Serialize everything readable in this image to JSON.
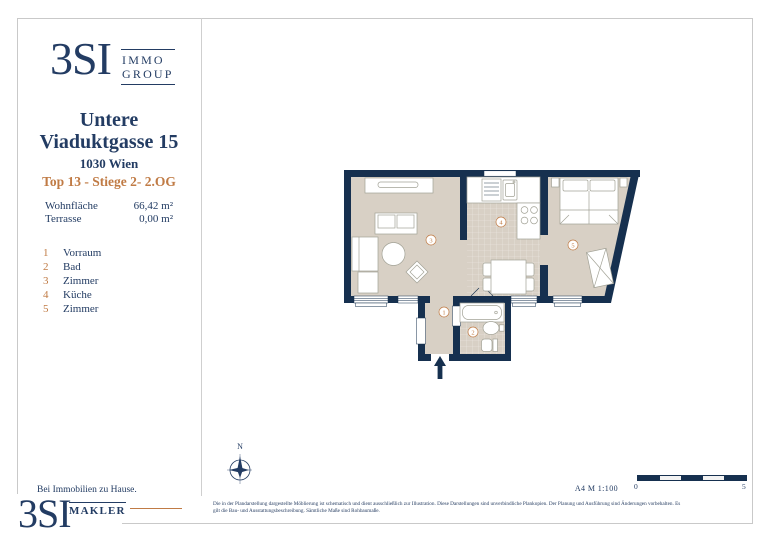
{
  "brand": {
    "name": "3SI",
    "group_line1": "IMMO",
    "group_line2": "GROUP",
    "makler_name": "3SI",
    "makler_label": "MAKLER",
    "tagline": "Bei Immobilien zu Hause."
  },
  "listing": {
    "street_line1": "Untere",
    "street_line2": "Viaduktgasse 15",
    "city": "1030 Wien",
    "unit_info": "Top 13 - Stiege 2- 2.OG",
    "areas": [
      {
        "label": "Wohnfläche",
        "value": "66,42 m²"
      },
      {
        "label": "Terrasse",
        "value": "0,00 m²"
      }
    ]
  },
  "rooms": [
    {
      "nr": "1",
      "name": "Vorraum"
    },
    {
      "nr": "2",
      "name": "Bad"
    },
    {
      "nr": "3",
      "name": "Zimmer"
    },
    {
      "nr": "4",
      "name": "Küche"
    },
    {
      "nr": "5",
      "name": "Zimmer"
    }
  ],
  "plan_footer": {
    "north_label": "N",
    "format_scale": "A4  M 1:100",
    "scale_start": "0",
    "scale_end": "5"
  },
  "disclaimer": {
    "line1": "Die in der Plandarstellung dargestellte Möblierung ist schematisch und dient ausschließlich zur Illustration. Diese Darstellungen sind unverbindliche Plankopien. Der Planung und Ausführung sind Änderungen vorbehalten. Es",
    "line2": "gilt die Bau- und Ausstattungsbeschreibung. Sämtliche Maße sind Rohbaumaße."
  },
  "colors": {
    "navy": "#233c63",
    "wall": "#16304f",
    "accent": "#c07b45",
    "floor": "#d8d0c5",
    "border": "#c9c9c9"
  }
}
